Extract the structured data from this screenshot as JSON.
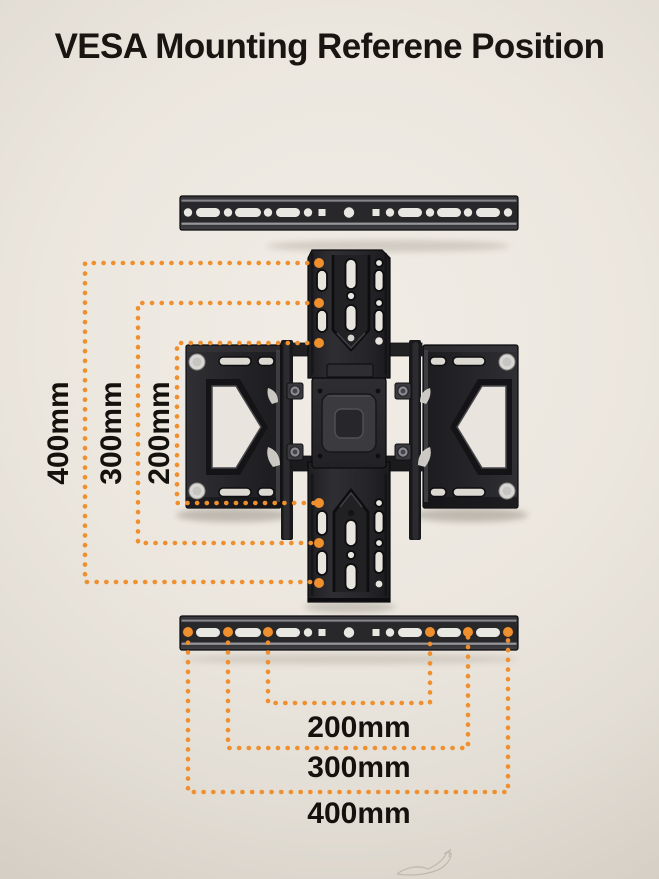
{
  "title": "VESA Mounting Referene Position",
  "accent_color": "#ef8f2d",
  "measurements": {
    "vertical_spacings": [
      {
        "label": "400mm"
      },
      {
        "label": "300mm"
      },
      {
        "label": "200mm"
      }
    ],
    "horizontal_spacings": [
      {
        "label": "200mm"
      },
      {
        "label": "300mm"
      },
      {
        "label": "400mm"
      }
    ]
  }
}
